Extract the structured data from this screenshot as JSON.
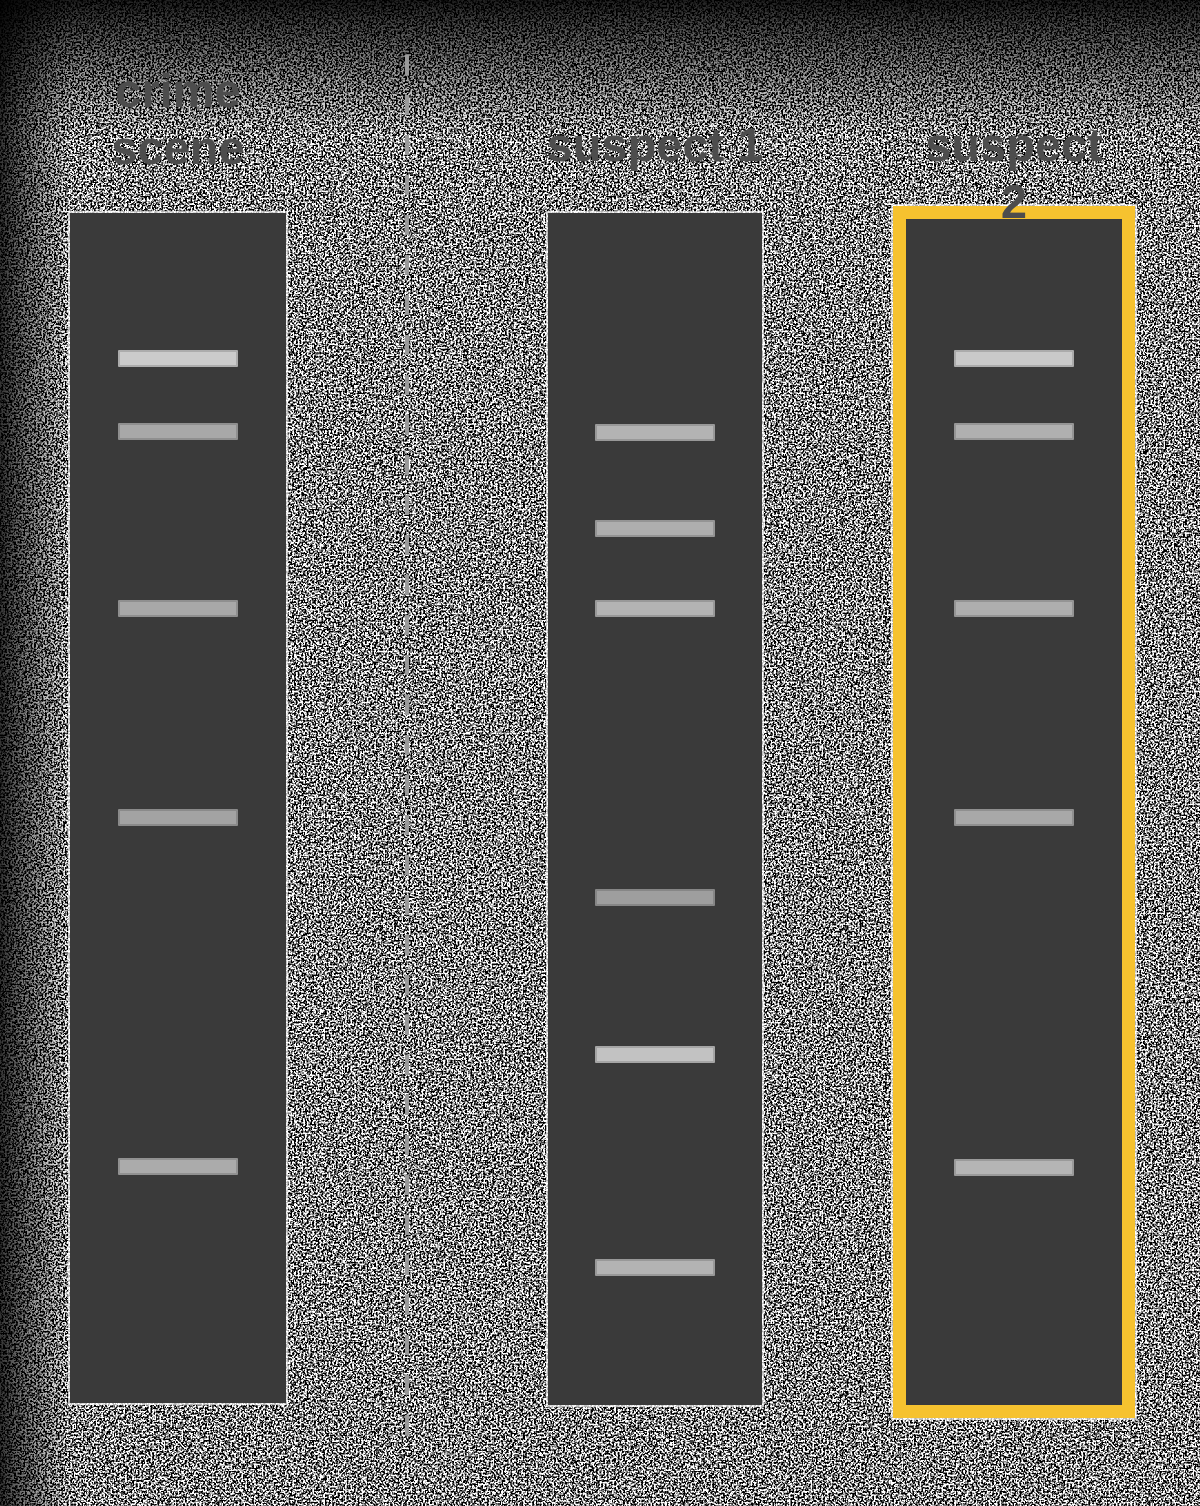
{
  "figure": {
    "kind": "dna-gel-electrophoresis-comparison",
    "colors": {
      "lane_fill": "#3a3a3a",
      "highlight": "#f6c22f",
      "label_text": "#4d4d4d",
      "divider": "#9a9a9a",
      "lane_outline": "rgba(255,255,255,0.7)"
    },
    "band_size": {
      "width": 120,
      "height": 17
    },
    "divider": {
      "x": 405,
      "top": 55,
      "bottom": 1445,
      "dash": 20,
      "gap": 20,
      "width": 4
    },
    "lanes": [
      {
        "id": "crime-scene",
        "label": "crime\nscene",
        "label_top": 62,
        "x": 70,
        "y": 213,
        "width": 216,
        "height": 1190,
        "highlighted": false,
        "bands": [
          {
            "y": 350,
            "color": "#cbcbcb"
          },
          {
            "y": 423,
            "color": "#a8a8a8"
          },
          {
            "y": 600,
            "color": "#a8a8a8"
          },
          {
            "y": 809,
            "color": "#a3a3a3"
          },
          {
            "y": 1158,
            "color": "#ababab"
          }
        ]
      },
      {
        "id": "suspect-1",
        "label": "suspect 1",
        "label_top": 116,
        "x": 548,
        "y": 213,
        "width": 214,
        "height": 1192,
        "highlighted": false,
        "bands": [
          {
            "y": 424,
            "color": "#b3b3b3"
          },
          {
            "y": 520,
            "color": "#aeaeae"
          },
          {
            "y": 600,
            "color": "#b3b3b3"
          },
          {
            "y": 889,
            "color": "#9e9e9e"
          },
          {
            "y": 1046,
            "color": "#c2c2c2"
          },
          {
            "y": 1259,
            "color": "#b3b3b3"
          }
        ]
      },
      {
        "id": "suspect-2",
        "label": "suspect 2",
        "label_top": 116,
        "x": 906,
        "y": 219,
        "width": 216,
        "height": 1186,
        "highlighted": true,
        "bands": [
          {
            "y": 350,
            "color": "#c9c9c9"
          },
          {
            "y": 423,
            "color": "#b0b0b0"
          },
          {
            "y": 600,
            "color": "#aeaeae"
          },
          {
            "y": 809,
            "color": "#a8a8a8"
          },
          {
            "y": 1159,
            "color": "#b5b5b5"
          }
        ]
      }
    ]
  }
}
